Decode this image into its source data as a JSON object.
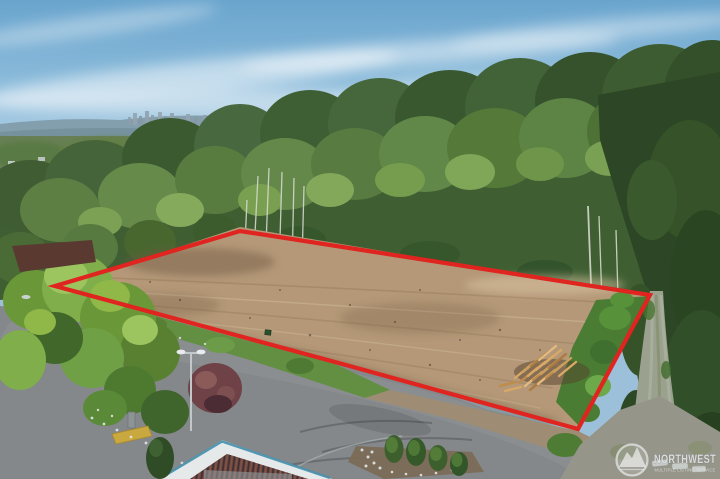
{
  "scene": {
    "description": "Aerial drone photo of a cleared tan dirt land parcel outlined with a red quadrilateral boundary, backed by dense green forest and a distant city skyline under a blue sky with wispy clouds; foreground shows an asphalt road and parking lot, a commercial building roof corner, landscaped shrubs, a street light, a log pile on the lot, and a gravel lane on the right",
    "subject": "vacant-land-parcel",
    "boundary_shape": "quadrilateral"
  },
  "watermark": {
    "brand": "NORTHWEST",
    "tagline": "MULTIPLE LISTING SERVICE",
    "logo": "mountain-circle-icon"
  },
  "colors": {
    "boundary_red": "#e0241f",
    "dirt_tan": "#b49878",
    "sky_blue": "#74add2",
    "forest_green": "#46663c",
    "asphalt_gray": "#84888b",
    "gravel_gray": "#9aa18e",
    "watermark_text": "#e6eaec"
  }
}
